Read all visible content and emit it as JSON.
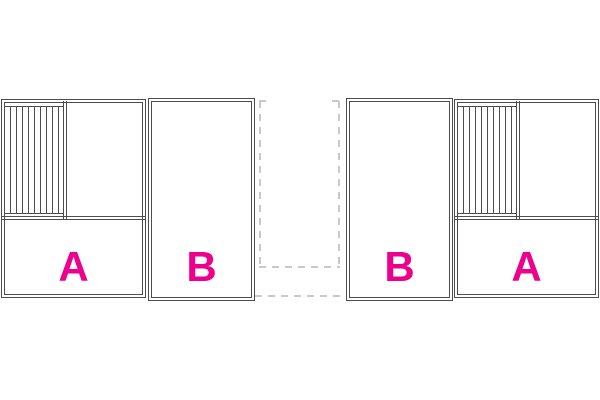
{
  "canvas": {
    "width": 600,
    "height": 400,
    "background": "#ffffff"
  },
  "style": {
    "line_color": "#4d4d4d",
    "dash_color": "#c9c9c9",
    "label_color": "#ec008c"
  },
  "plans": {
    "left_unit": {
      "room_a_label": "A",
      "room_b_label": "B"
    },
    "right_unit": {
      "room_a_label": "A",
      "room_b_label": "B"
    }
  }
}
